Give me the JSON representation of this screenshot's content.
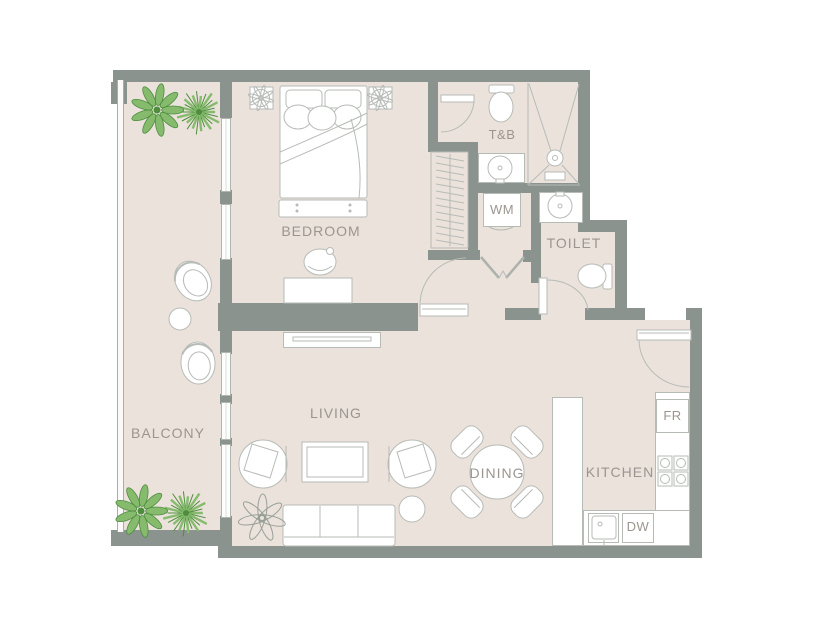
{
  "colors": {
    "wall": "#8b938e",
    "floor": "#ebe2dc",
    "furniture_line": "#b7bbb6",
    "label_text": "#9c958f",
    "plant_light_green": "#86bb6e",
    "plant_dark_green": "#4e8d3e"
  },
  "rooms": {
    "balcony": {
      "label": "BALCONY"
    },
    "bedroom": {
      "label": "BEDROOM"
    },
    "living": {
      "label": "LIVING"
    },
    "dining": {
      "label": "DINING"
    },
    "kitchen": {
      "label": "KITCHEN"
    },
    "toilet_bath": {
      "label": "T&B"
    },
    "toilet": {
      "label": "TOILET"
    }
  },
  "appliances": {
    "washing_machine": {
      "label": "WM"
    },
    "fridge": {
      "label": "FR"
    },
    "dishwasher": {
      "label": "DW"
    }
  }
}
